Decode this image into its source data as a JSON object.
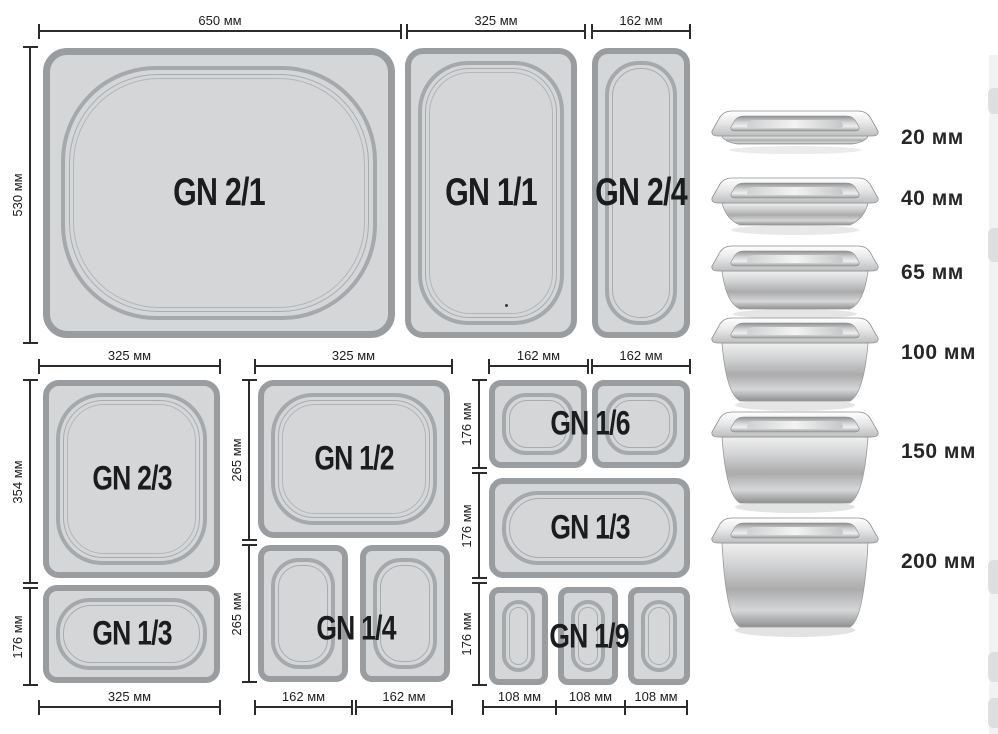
{
  "diagram_title": "Gastronorm pan sizes",
  "colors": {
    "pan_fill": "#d4d6d8",
    "pan_border": "#9a9da0",
    "inner_ring": "#a6a9ac",
    "dimension_line": "#2b2b2b",
    "label_text": "#1b1c1e"
  },
  "row1": {
    "width_dims": [
      "650 мм",
      "325 мм",
      "162 мм"
    ],
    "height_dim": "530 мм",
    "pan_labels": [
      "GN 2/1",
      "GN 1/1",
      "GN 2/4"
    ]
  },
  "group_left": {
    "top_dim": "325 мм",
    "height_dims": [
      "354 мм",
      "176 мм"
    ],
    "pan_labels": [
      "GN 2/3",
      "GN 1/3"
    ],
    "bottom_dim": "325 мм"
  },
  "group_middle": {
    "top_dim": "325 мм",
    "height_dims": [
      "265 мм",
      "265 мм"
    ],
    "pan_labels": [
      "GN 1/2",
      "GN 1/4"
    ],
    "bottom_dims": [
      "162 мм",
      "162 мм"
    ]
  },
  "group_right": {
    "top_dims": [
      "162 мм",
      "162 мм"
    ],
    "height_dims": [
      "176 мм",
      "176 мм",
      "176 мм"
    ],
    "pan_labels": [
      "GN 1/6",
      "GN 1/3",
      "GN 1/9"
    ],
    "bottom_dims": [
      "108 мм",
      "108 мм",
      "108 мм"
    ]
  },
  "depth_column": {
    "labels": [
      "20 мм",
      "40 мм",
      "65 мм",
      "100 мм",
      "150 мм",
      "200 мм"
    ]
  }
}
